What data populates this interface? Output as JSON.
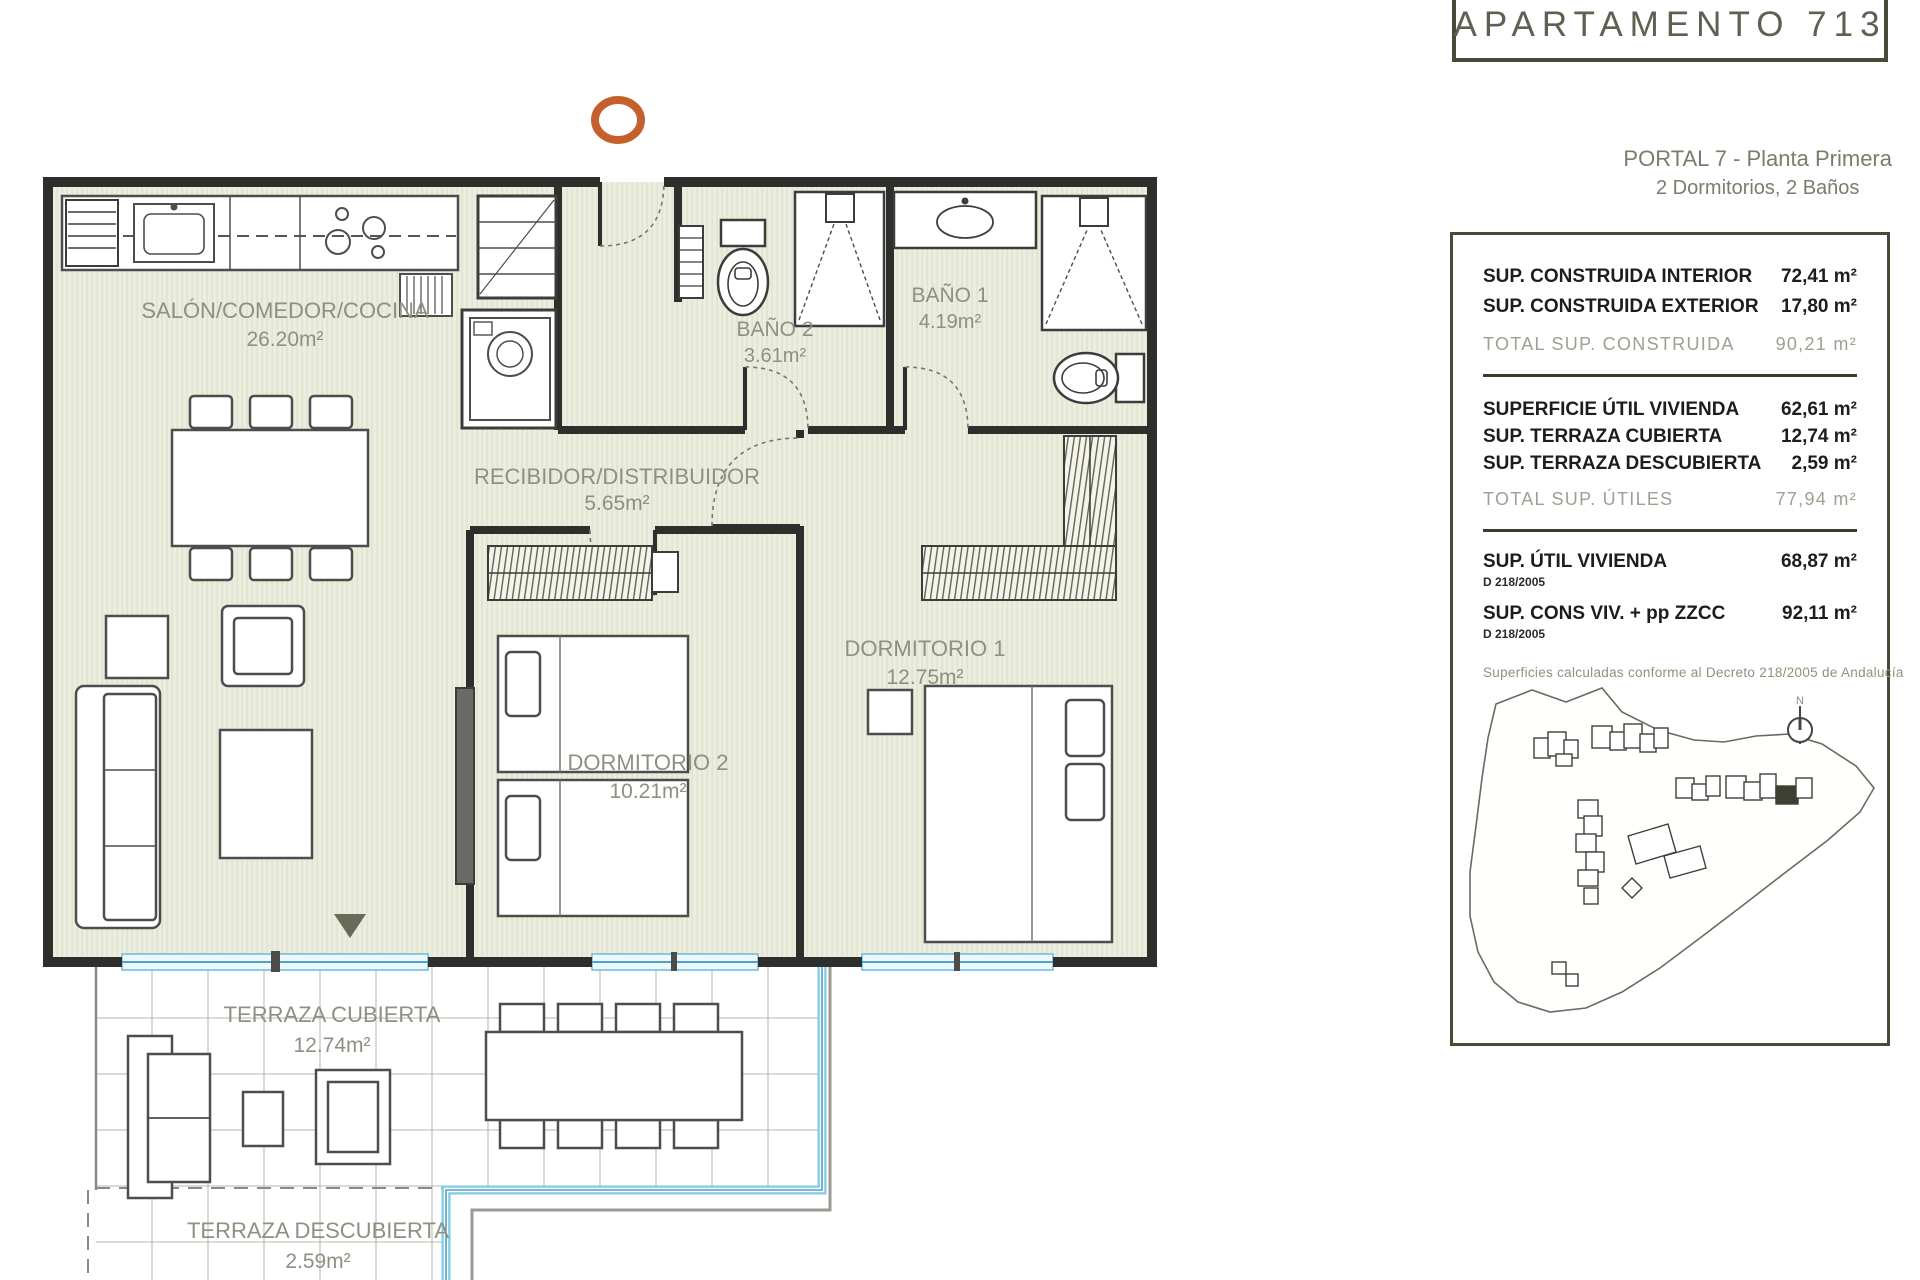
{
  "header": {
    "apartment_title": "APARTAMENTO 713",
    "portal_line": "PORTAL 7 - Planta Primera",
    "config_line": "2 Dormitorios, 2 Baños"
  },
  "plan": {
    "rooms": [
      {
        "name": "SALÓN/COMEDOR/COCINA",
        "area": "26.20m²"
      },
      {
        "name": "RECIBIDOR/DISTRIBUIDOR",
        "area": "5.65m²"
      },
      {
        "name": "BAÑO 2",
        "area": "3.61m²"
      },
      {
        "name": "BAÑO 1",
        "area": "4.19m²"
      },
      {
        "name": "DORMITORIO 1",
        "area": "12.75m²"
      },
      {
        "name": "DORMITORIO 2",
        "area": "10.21m²"
      },
      {
        "name": "TERRAZA CUBIERTA",
        "area": "12.74m²"
      },
      {
        "name": "TERRAZA DESCUBIERTA",
        "area": "2.59m²"
      }
    ]
  },
  "surfaces_panel": {
    "constructed_rows": [
      {
        "label": "SUP. CONSTRUIDA INTERIOR",
        "value": "72,41 m²"
      },
      {
        "label": "SUP. CONSTRUIDA EXTERIOR",
        "value": "17,80 m²"
      }
    ],
    "constructed_total": {
      "label": "TOTAL SUP. CONSTRUIDA",
      "value": "90,21 m²"
    },
    "useful_rows": [
      {
        "label": "SUPERFICIE ÚTIL VIVIENDA",
        "value": "62,61 m²"
      },
      {
        "label": "SUP. TERRAZA CUBIERTA",
        "value": "12,74 m²"
      },
      {
        "label": "SUP. TERRAZA DESCUBIERTA",
        "value": "2,59 m²"
      }
    ],
    "useful_total": {
      "label": "TOTAL SUP. ÚTILES",
      "value": "77,94 m²"
    },
    "decree_rows": [
      {
        "label": "SUP. ÚTIL VIVIENDA",
        "decree": "D 218/2005",
        "value": "68,87 m²"
      },
      {
        "label": "SUP. CONS VIV. + pp ZZCC",
        "decree": "D 218/2005",
        "value": "92,11 m²"
      }
    ],
    "note": "Superficies calculadas conforme al Decreto 218/2005 de Andalucía",
    "site_map": {
      "north_label": "N"
    }
  },
  "colors": {
    "panel_border": "#474b38",
    "accent_orange": "#c4602c",
    "window_blue": "#5fb5d6",
    "label_gray": "#8d9082"
  }
}
